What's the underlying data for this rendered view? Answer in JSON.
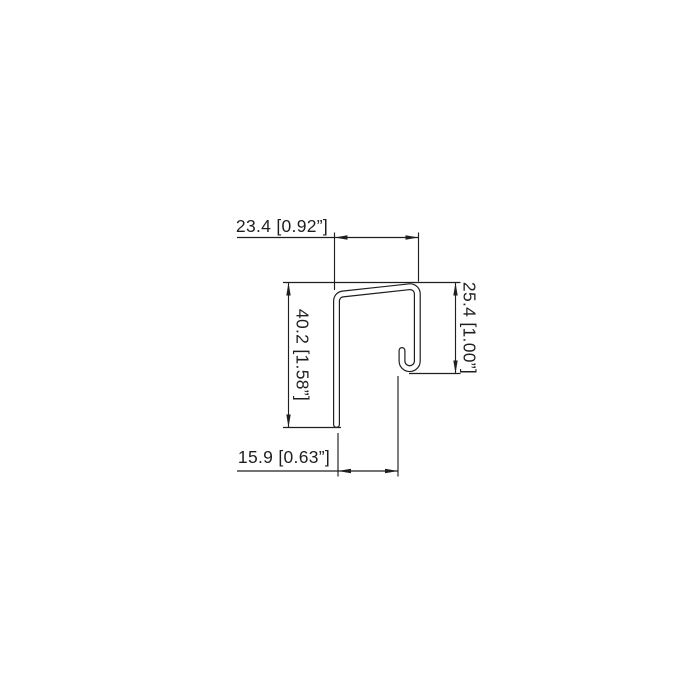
{
  "colors": {
    "background": "#ffffff",
    "line": "#1f1f1f"
  },
  "drawing": {
    "type": "sheet-metal profile cross-section with dimensions",
    "dimensions": {
      "top_width": {
        "label": "23.4 [0.92”]",
        "mm": "23.4",
        "inches": "0.92”"
      },
      "right_height": {
        "label": "25.4 [1.00”]",
        "mm": "25.4",
        "inches": "1.00”"
      },
      "left_height": {
        "label": "40.2 [1.58”]",
        "mm": "40.2",
        "inches": "1.58”"
      },
      "bottom_width": {
        "label": "15.9 [0.63”]",
        "mm": "15.9",
        "inches": "0.63”"
      }
    }
  }
}
